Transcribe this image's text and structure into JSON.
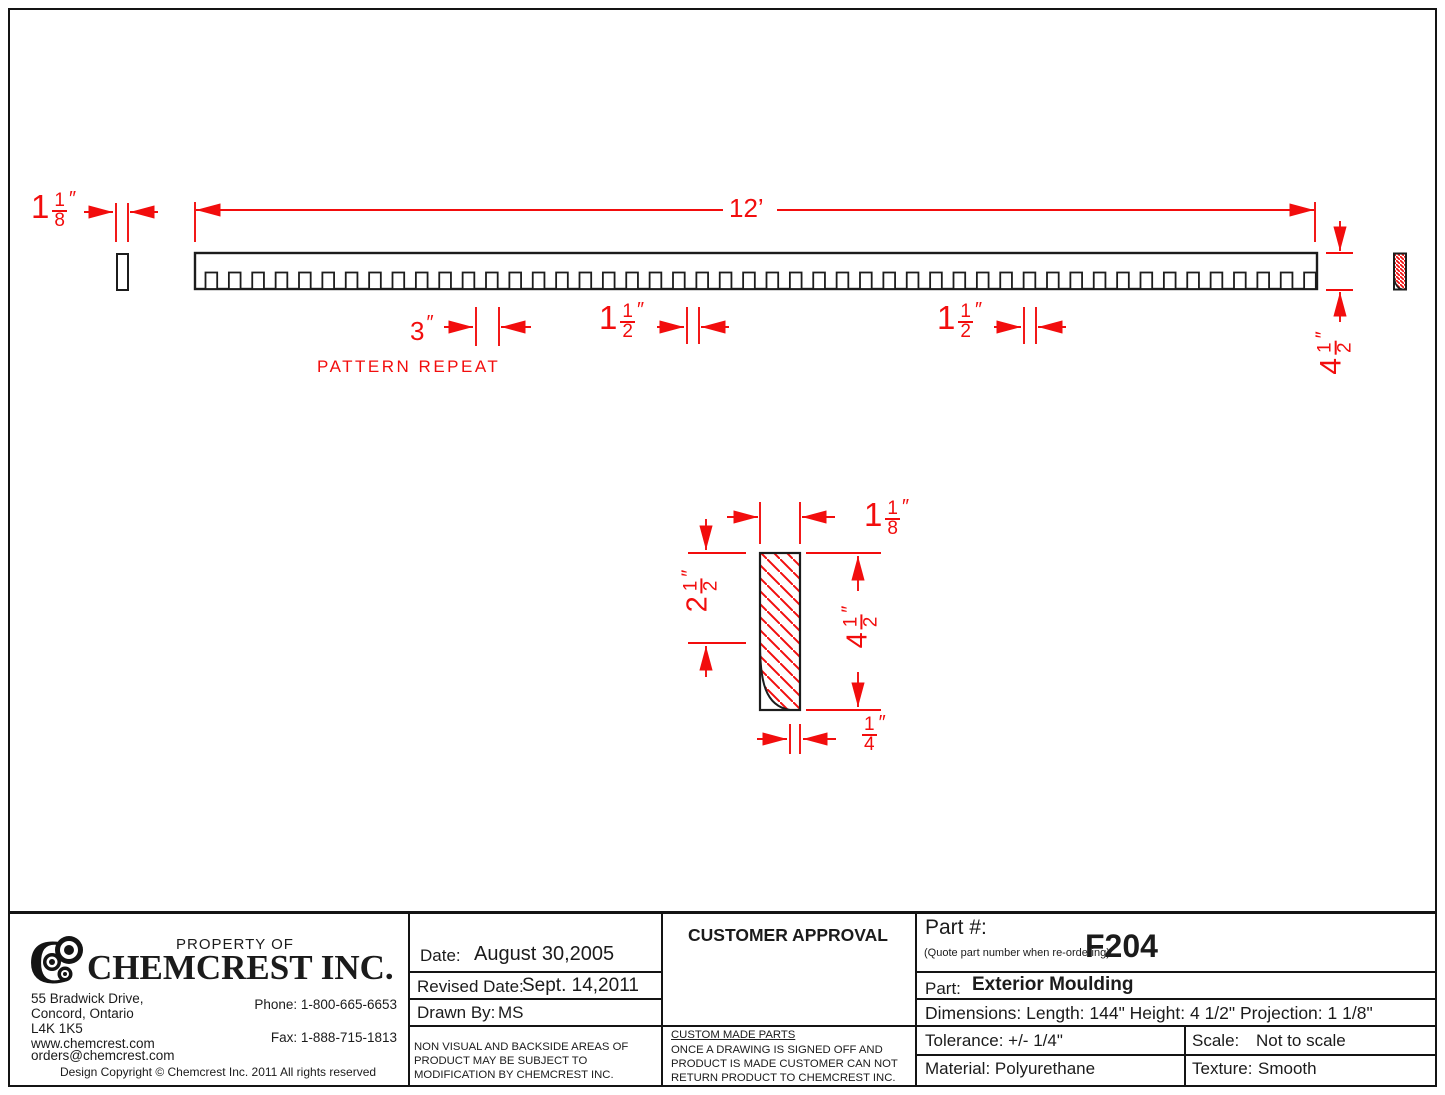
{
  "drawing": {
    "labels": {
      "length": "12’",
      "pattern_repeat": "PATTERN REPEAT"
    },
    "dims": {
      "end_projection": {
        "whole": "1",
        "num": "1",
        "den": "8",
        "unit": "″"
      },
      "pattern": {
        "whole": "3",
        "unit": "″"
      },
      "dentil_a": {
        "whole": "1",
        "num": "1",
        "den": "2",
        "unit": "″"
      },
      "dentil_b": {
        "whole": "1",
        "num": "1",
        "den": "2",
        "unit": "″"
      },
      "end_height": {
        "whole": "4",
        "num": "1",
        "den": "2",
        "unit": "″"
      },
      "cs_width": {
        "whole": "1",
        "num": "1",
        "den": "8",
        "unit": "″"
      },
      "cs_upper": {
        "whole": "2",
        "num": "1",
        "den": "2",
        "unit": "″"
      },
      "cs_total": {
        "whole": "4",
        "num": "1",
        "den": "2",
        "unit": "″"
      },
      "cs_bottom": {
        "num": "1",
        "den": "4",
        "unit": "″"
      }
    },
    "dentil": {
      "count": 48,
      "pattern_repeat_in": 3,
      "dentil_width_in": 1.5,
      "length_in": 144
    }
  },
  "title_block": {
    "property_of": "PROPERTY OF",
    "company": "CHEMCREST INC.",
    "address1": "55 Bradwick Drive,",
    "address2": "Concord, Ontario",
    "address3": "L4K 1K5",
    "website": "www.chemcrest.com",
    "email": "orders@chemcrest.com",
    "phone": "Phone: 1-800-665-6653",
    "fax": "Fax: 1-888-715-1813",
    "copyright": "Design Copyright © Chemcrest Inc. 2011 All rights reserved",
    "date_label": "Date:",
    "date": "August 30,2005",
    "revised_label": "Revised Date:",
    "revised": "Sept. 14,2011",
    "drawn_label": "Drawn By:",
    "drawn": "MS",
    "mod_note": "NON VISUAL AND BACKSIDE AREAS OF PRODUCT MAY BE SUBJECT TO MODIFICATION BY CHEMCREST INC.",
    "approval_title": "CUSTOMER APPROVAL",
    "custom_title": "CUSTOM MADE PARTS",
    "custom_note": "ONCE A DRAWING IS SIGNED OFF AND PRODUCT IS MADE CUSTOMER CAN NOT RETURN PRODUCT TO CHEMCREST INC.",
    "part_no_label": "Part #:",
    "part_no_sub": "(Quote part number when re-ordering)",
    "part_no": "F204",
    "part_label": "Part:",
    "part_name": "Exterior Moulding",
    "dimensions": "Dimensions: Length: 144\" Height: 4 1/2\" Projection: 1 1/8\"",
    "tolerance": "Tolerance: +/- 1/4\"",
    "scale_label": "Scale:",
    "scale": "Not to scale",
    "material": "Material: Polyurethane",
    "texture_label": "Texture:",
    "texture": "Smooth"
  }
}
